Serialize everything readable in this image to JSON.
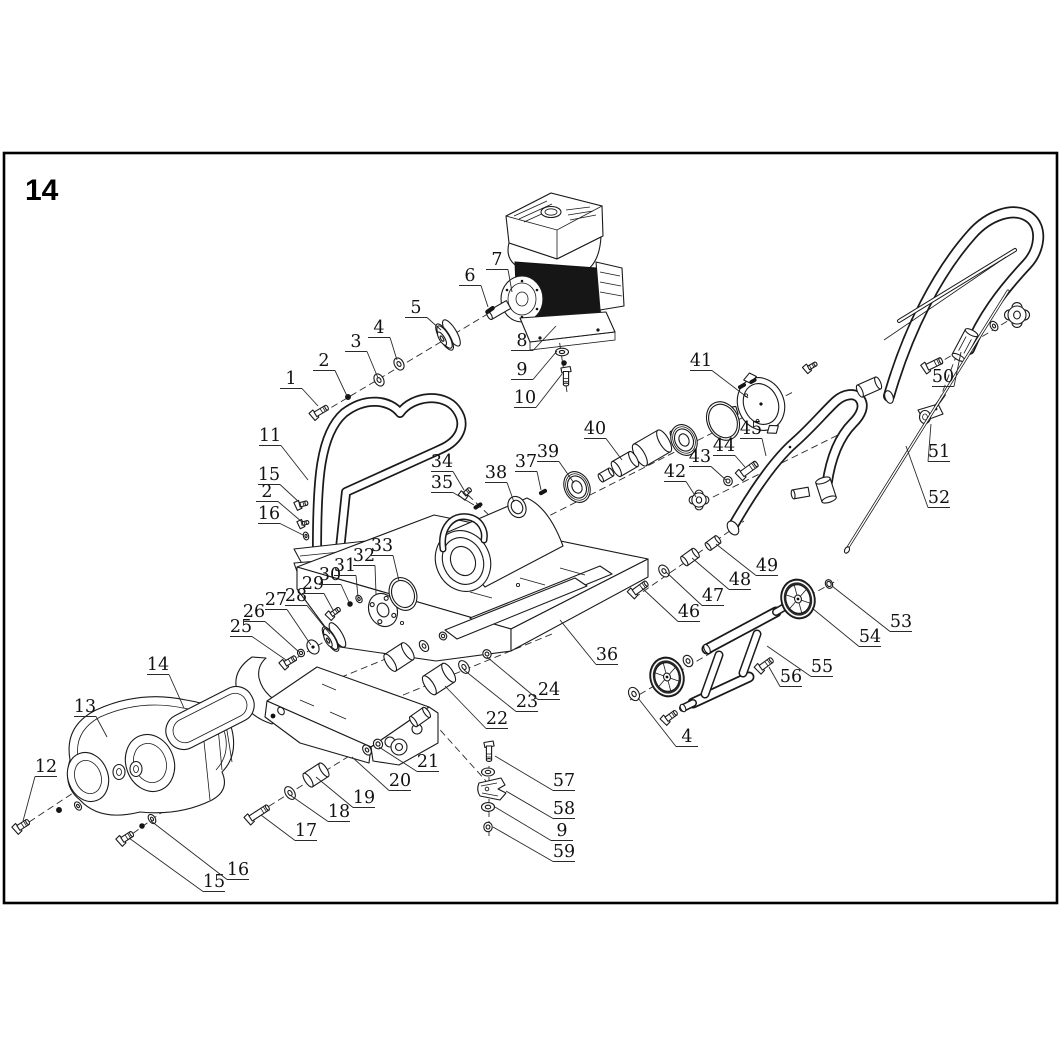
{
  "page": {
    "number": "14"
  },
  "figure": {
    "description": "Exploded parts diagram of a gasoline plate compactor",
    "frame_color": "#000000",
    "line_color": "#1a1a1a",
    "background": "#ffffff"
  },
  "callouts": [
    {
      "n": "1",
      "x": 291,
      "y": 384,
      "tx": 318,
      "ty": 406
    },
    {
      "n": "2",
      "x": 324,
      "y": 366,
      "tx": 347,
      "ty": 396
    },
    {
      "n": "3",
      "x": 356,
      "y": 347,
      "tx": 378,
      "ty": 378
    },
    {
      "n": "4",
      "x": 379,
      "y": 333,
      "tx": 397,
      "ty": 360
    },
    {
      "n": "5",
      "x": 416,
      "y": 313,
      "tx": 441,
      "ty": 330
    },
    {
      "n": "6",
      "x": 470,
      "y": 281,
      "tx": 488,
      "ty": 307
    },
    {
      "n": "7",
      "x": 497,
      "y": 265,
      "tx": 512,
      "ty": 292
    },
    {
      "n": "8",
      "x": 522,
      "y": 346,
      "tx": 556,
      "ty": 326
    },
    {
      "n": "9",
      "x": 522,
      "y": 375,
      "tx": 557,
      "ty": 351
    },
    {
      "n": "10",
      "x": 525,
      "y": 403,
      "tx": 562,
      "ty": 374
    },
    {
      "n": "11",
      "x": 270,
      "y": 441,
      "tx": 308,
      "ty": 480
    },
    {
      "n": "15",
      "x": 269,
      "y": 480,
      "tx": 300,
      "ty": 503
    },
    {
      "n": "2",
      "x": 267,
      "y": 497,
      "tx": 302,
      "ty": 522
    },
    {
      "n": "16",
      "x": 269,
      "y": 519,
      "tx": 303,
      "ty": 535
    },
    {
      "n": "12",
      "x": 46,
      "y": 772,
      "tx": 23,
      "ty": 821
    },
    {
      "n": "13",
      "x": 85,
      "y": 712,
      "tx": 107,
      "ty": 737
    },
    {
      "n": "14",
      "x": 158,
      "y": 670,
      "tx": 184,
      "ty": 708
    },
    {
      "n": "15",
      "x": 214,
      "y": 887,
      "tx": 129,
      "ty": 838
    },
    {
      "n": "16",
      "x": 238,
      "y": 875,
      "tx": 151,
      "ty": 821
    },
    {
      "n": "17",
      "x": 306,
      "y": 836,
      "tx": 261,
      "ty": 815
    },
    {
      "n": "18",
      "x": 339,
      "y": 817,
      "tx": 290,
      "ty": 795
    },
    {
      "n": "19",
      "x": 364,
      "y": 803,
      "tx": 316,
      "ty": 777
    },
    {
      "n": "20",
      "x": 400,
      "y": 786,
      "tx": 352,
      "ty": 757
    },
    {
      "n": "21",
      "x": 428,
      "y": 767,
      "tx": 379,
      "ty": 747
    },
    {
      "n": "22",
      "x": 497,
      "y": 724,
      "tx": 445,
      "ty": 686
    },
    {
      "n": "23",
      "x": 527,
      "y": 707,
      "tx": 464,
      "ty": 670
    },
    {
      "n": "24",
      "x": 549,
      "y": 695,
      "tx": 487,
      "ty": 657
    },
    {
      "n": "25",
      "x": 241,
      "y": 632,
      "tx": 286,
      "ty": 660
    },
    {
      "n": "26",
      "x": 254,
      "y": 617,
      "tx": 299,
      "ty": 652
    },
    {
      "n": "27",
      "x": 276,
      "y": 605,
      "tx": 311,
      "ty": 645
    },
    {
      "n": "28",
      "x": 296,
      "y": 601,
      "tx": 330,
      "ty": 634
    },
    {
      "n": "29",
      "x": 313,
      "y": 589,
      "tx": 333,
      "ty": 610
    },
    {
      "n": "30",
      "x": 330,
      "y": 580,
      "tx": 349,
      "ty": 602
    },
    {
      "n": "31",
      "x": 345,
      "y": 571,
      "tx": 358,
      "ty": 597
    },
    {
      "n": "32",
      "x": 364,
      "y": 561,
      "tx": 376,
      "ty": 594
    },
    {
      "n": "33",
      "x": 382,
      "y": 551,
      "tx": 399,
      "ty": 581
    },
    {
      "n": "34",
      "x": 442,
      "y": 467,
      "tx": 464,
      "ty": 490
    },
    {
      "n": "35",
      "x": 442,
      "y": 488,
      "tx": 474,
      "ty": 505
    },
    {
      "n": "36",
      "x": 607,
      "y": 660,
      "tx": 560,
      "ty": 620
    },
    {
      "n": "37",
      "x": 526,
      "y": 467,
      "tx": 541,
      "ty": 490
    },
    {
      "n": "38",
      "x": 496,
      "y": 478,
      "tx": 514,
      "ty": 502
    },
    {
      "n": "39",
      "x": 548,
      "y": 457,
      "tx": 574,
      "ty": 483
    },
    {
      "n": "40",
      "x": 595,
      "y": 434,
      "tx": 622,
      "ty": 460
    },
    {
      "n": "41",
      "x": 701,
      "y": 366,
      "tx": 748,
      "ty": 398
    },
    {
      "n": "42",
      "x": 675,
      "y": 477,
      "tx": 696,
      "ty": 497
    },
    {
      "n": "43",
      "x": 700,
      "y": 462,
      "tx": 726,
      "ty": 480
    },
    {
      "n": "44",
      "x": 724,
      "y": 451,
      "tx": 745,
      "ty": 467
    },
    {
      "n": "45",
      "x": 751,
      "y": 434,
      "tx": 766,
      "ty": 456
    },
    {
      "n": "46",
      "x": 689,
      "y": 617,
      "tx": 642,
      "ty": 588
    },
    {
      "n": "47",
      "x": 713,
      "y": 601,
      "tx": 666,
      "ty": 572
    },
    {
      "n": "48",
      "x": 740,
      "y": 585,
      "tx": 692,
      "ty": 558
    },
    {
      "n": "49",
      "x": 767,
      "y": 571,
      "tx": 716,
      "ty": 544
    },
    {
      "n": "50",
      "x": 943,
      "y": 382,
      "tx": 961,
      "ty": 352
    },
    {
      "n": "51",
      "x": 939,
      "y": 457,
      "tx": 931,
      "ty": 424
    },
    {
      "n": "52",
      "x": 939,
      "y": 503,
      "tx": 906,
      "ty": 446
    },
    {
      "n": "53",
      "x": 901,
      "y": 627,
      "tx": 832,
      "ty": 586
    },
    {
      "n": "54",
      "x": 870,
      "y": 642,
      "tx": 812,
      "ty": 608
    },
    {
      "n": "55",
      "x": 822,
      "y": 672,
      "tx": 767,
      "ty": 646
    },
    {
      "n": "56",
      "x": 791,
      "y": 682,
      "tx": 769,
      "ty": 667
    },
    {
      "n": "4",
      "x": 687,
      "y": 742,
      "tx": 638,
      "ty": 698
    },
    {
      "n": "57",
      "x": 564,
      "y": 786,
      "tx": 495,
      "ty": 756
    },
    {
      "n": "58",
      "x": 564,
      "y": 814,
      "tx": 506,
      "ty": 791
    },
    {
      "n": "9",
      "x": 562,
      "y": 836,
      "tx": 495,
      "ty": 807
    },
    {
      "n": "59",
      "x": 564,
      "y": 857,
      "tx": 493,
      "ty": 827
    }
  ],
  "axes": [
    {
      "x1": 322,
      "y1": 413,
      "x2": 506,
      "y2": 303
    },
    {
      "x1": 558,
      "y1": 332,
      "x2": 567,
      "y2": 392
    },
    {
      "x1": 462,
      "y1": 560,
      "x2": 795,
      "y2": 391
    },
    {
      "x1": 468,
      "y1": 495,
      "x2": 494,
      "y2": 520
    },
    {
      "x1": 703,
      "y1": 502,
      "x2": 846,
      "y2": 431
    },
    {
      "x1": 634,
      "y1": 598,
      "x2": 744,
      "y2": 521
    },
    {
      "x1": 630,
      "y1": 700,
      "x2": 716,
      "y2": 650
    },
    {
      "x1": 770,
      "y1": 617,
      "x2": 838,
      "y2": 580
    },
    {
      "x1": 926,
      "y1": 371,
      "x2": 1024,
      "y2": 311
    },
    {
      "x1": 957,
      "y1": 354,
      "x2": 936,
      "y2": 409
    },
    {
      "x1": 288,
      "y1": 663,
      "x2": 460,
      "y2": 562
    },
    {
      "x1": 337,
      "y1": 611,
      "x2": 390,
      "y2": 591
    },
    {
      "x1": 352,
      "y1": 716,
      "x2": 552,
      "y2": 634
    },
    {
      "x1": 310,
      "y1": 690,
      "x2": 500,
      "y2": 612
    },
    {
      "x1": 250,
      "y1": 818,
      "x2": 362,
      "y2": 748
    },
    {
      "x1": 20,
      "y1": 828,
      "x2": 108,
      "y2": 770
    },
    {
      "x1": 124,
      "y1": 840,
      "x2": 195,
      "y2": 788
    },
    {
      "x1": 489,
      "y1": 744,
      "x2": 489,
      "y2": 836
    },
    {
      "x1": 433,
      "y1": 722,
      "x2": 486,
      "y2": 781
    },
    {
      "x1": 176,
      "y1": 734,
      "x2": 240,
      "y2": 700
    }
  ],
  "hardware": [
    {
      "t": "bolt",
      "x": 321,
      "y": 411,
      "rot": -31,
      "a": 15,
      "b": 2.6
    },
    {
      "t": "dot",
      "x": 348,
      "y": 397,
      "rot": 0,
      "a": 2.6,
      "b": 0
    },
    {
      "t": "washer",
      "x": 379,
      "y": 380,
      "rot": -31,
      "a": 4.5,
      "b": 6.5
    },
    {
      "t": "washer",
      "x": 399,
      "y": 364,
      "rot": -31,
      "a": 4.5,
      "b": 6.5
    },
    {
      "t": "pulley",
      "x": 448,
      "y": 335,
      "rot": -31,
      "a": 15,
      "b": 0
    },
    {
      "t": "pin",
      "x": 490,
      "y": 310,
      "rot": -35,
      "a": 10,
      "b": 1.8
    },
    {
      "t": "washerF",
      "x": 562,
      "y": 352,
      "rot": 0,
      "a": 6.5,
      "b": 3.8
    },
    {
      "t": "dot",
      "x": 564,
      "y": 363,
      "rot": 0,
      "a": 2.4,
      "b": 0
    },
    {
      "t": "bolt",
      "x": 566,
      "y": 378,
      "rot": 90,
      "a": 15,
      "b": 2.6
    },
    {
      "t": "bolt",
      "x": 303,
      "y": 504,
      "rot": -15,
      "a": 9,
      "b": 2.2
    },
    {
      "t": "bolt",
      "x": 305,
      "y": 523,
      "rot": -15,
      "a": 7,
      "b": 1.8
    },
    {
      "t": "washer",
      "x": 306,
      "y": 536,
      "rot": -15,
      "a": 2.6,
      "b": 4
    },
    {
      "t": "bolt",
      "x": 467,
      "y": 492,
      "rot": -42,
      "a": 9,
      "b": 2.2
    },
    {
      "t": "pin",
      "x": 478,
      "y": 506,
      "rot": -32,
      "a": 9,
      "b": 1.7
    },
    {
      "t": "pin",
      "x": 543,
      "y": 492,
      "rot": -30,
      "a": 8,
      "b": 1.7
    },
    {
      "t": "ringp",
      "x": 517,
      "y": 507,
      "rot": -26,
      "a": 11,
      "b": 4
    },
    {
      "t": "bearing",
      "x": 577,
      "y": 487,
      "rot": -26,
      "a": 16,
      "b": 0
    },
    {
      "t": "cyl",
      "x": 679,
      "y": 433,
      "rot": -30,
      "a": 13,
      "b": 5.5
    },
    {
      "t": "cyl",
      "x": 652,
      "y": 448,
      "rot": -30,
      "a": 28,
      "b": 12.5
    },
    {
      "t": "cyl",
      "x": 625,
      "y": 464,
      "rot": -30,
      "a": 20,
      "b": 8.5
    },
    {
      "t": "cyl",
      "x": 606,
      "y": 475,
      "rot": -30,
      "a": 12,
      "b": 4.5
    },
    {
      "t": "bearing",
      "x": 684,
      "y": 440,
      "rot": -26,
      "a": 16,
      "b": 0
    },
    {
      "t": "ringp",
      "x": 723,
      "y": 421,
      "rot": -26,
      "a": 20,
      "b": 2.6
    },
    {
      "t": "pin",
      "x": 742,
      "y": 386,
      "rot": -30,
      "a": 8,
      "b": 1.6
    },
    {
      "t": "pin",
      "x": 753,
      "y": 381,
      "rot": -30,
      "a": 7,
      "b": 1.5
    },
    {
      "t": "bolt",
      "x": 812,
      "y": 366,
      "rot": -30,
      "a": 10,
      "b": 2
    },
    {
      "t": "star",
      "x": 699,
      "y": 500,
      "rot": 0,
      "a": 9.5,
      "b": 0
    },
    {
      "t": "nut",
      "x": 728,
      "y": 481,
      "rot": -26,
      "a": 4.2,
      "b": 0
    },
    {
      "t": "bolt",
      "x": 749,
      "y": 469,
      "rot": -36,
      "a": 19,
      "b": 3.2
    },
    {
      "t": "bolt",
      "x": 640,
      "y": 588,
      "rot": -36,
      "a": 17,
      "b": 3
    },
    {
      "t": "washer",
      "x": 664,
      "y": 571,
      "rot": -36,
      "a": 4.5,
      "b": 6.5
    },
    {
      "t": "cyl",
      "x": 690,
      "y": 557,
      "rot": -36,
      "a": 14,
      "b": 5.5
    },
    {
      "t": "cyl",
      "x": 713,
      "y": 543,
      "rot": -36,
      "a": 12,
      "b": 4.5
    },
    {
      "t": "washer",
      "x": 634,
      "y": 694,
      "rot": -28,
      "a": 5,
      "b": 7
    },
    {
      "t": "wheel",
      "x": 667,
      "y": 677,
      "rot": -15,
      "a": 20,
      "b": 0
    },
    {
      "t": "washer",
      "x": 688,
      "y": 661,
      "rot": -28,
      "a": 4.5,
      "b": 6
    },
    {
      "t": "wheel",
      "x": 798,
      "y": 599,
      "rot": -15,
      "a": 20,
      "b": 0
    },
    {
      "t": "ringp",
      "x": 829,
      "y": 584,
      "rot": -26,
      "a": 4.5,
      "b": 1.8
    },
    {
      "t": "bolt",
      "x": 766,
      "y": 664,
      "rot": -36,
      "a": 15,
      "b": 2.8
    },
    {
      "t": "bolt",
      "x": 671,
      "y": 716,
      "rot": -36,
      "a": 13,
      "b": 2.6
    },
    {
      "t": "bolt",
      "x": 259,
      "y": 813,
      "rot": -33,
      "a": 22,
      "b": 3
    },
    {
      "t": "washer",
      "x": 290,
      "y": 793,
      "rot": -33,
      "a": 4.5,
      "b": 7
    },
    {
      "t": "cyl",
      "x": 316,
      "y": 775,
      "rot": -33,
      "a": 19,
      "b": 8
    },
    {
      "t": "washer",
      "x": 367,
      "y": 750,
      "rot": -33,
      "a": 3.8,
      "b": 5.5
    },
    {
      "t": "nut",
      "x": 378,
      "y": 744,
      "rot": -33,
      "a": 4.4,
      "b": 0
    },
    {
      "t": "cyl",
      "x": 399,
      "y": 657,
      "rot": -33,
      "a": 21,
      "b": 10
    },
    {
      "t": "washer",
      "x": 424,
      "y": 646,
      "rot": -33,
      "a": 4,
      "b": 6
    },
    {
      "t": "nut",
      "x": 443,
      "y": 636,
      "rot": -33,
      "a": 3.6,
      "b": 0
    },
    {
      "t": "cyl",
      "x": 439,
      "y": 679,
      "rot": -33,
      "a": 23,
      "b": 11
    },
    {
      "t": "washer",
      "x": 464,
      "y": 667,
      "rot": -33,
      "a": 4.5,
      "b": 7
    },
    {
      "t": "nut",
      "x": 487,
      "y": 654,
      "rot": -33,
      "a": 4,
      "b": 0
    },
    {
      "t": "bolt",
      "x": 290,
      "y": 661,
      "rot": -31,
      "a": 13,
      "b": 2.6
    },
    {
      "t": "nut",
      "x": 301,
      "y": 653,
      "rot": -31,
      "a": 3.4,
      "b": 0
    },
    {
      "t": "washerD",
      "x": 313,
      "y": 647,
      "rot": -31,
      "a": 5.5,
      "b": 7.5
    },
    {
      "t": "pulley",
      "x": 334,
      "y": 637,
      "rot": -31,
      "a": 14,
      "b": 0
    },
    {
      "t": "bolt",
      "x": 335,
      "y": 612,
      "rot": -36,
      "a": 11,
      "b": 2.2
    },
    {
      "t": "dot",
      "x": 350,
      "y": 604,
      "rot": 0,
      "a": 2.4,
      "b": 0
    },
    {
      "t": "washer",
      "x": 359,
      "y": 599,
      "rot": -31,
      "a": 2.8,
      "b": 4
    },
    {
      "t": "flange",
      "x": 383,
      "y": 610,
      "rot": -24,
      "a": 17,
      "b": 0
    },
    {
      "t": "ringp",
      "x": 403,
      "y": 594,
      "rot": -24,
      "a": 17,
      "b": 3
    },
    {
      "t": "bolt",
      "x": 23,
      "y": 825,
      "rot": -33,
      "a": 13,
      "b": 2.8
    },
    {
      "t": "dot",
      "x": 59,
      "y": 810,
      "rot": 0,
      "a": 2.6,
      "b": 0
    },
    {
      "t": "washer",
      "x": 78,
      "y": 806,
      "rot": -33,
      "a": 3,
      "b": 4.5
    },
    {
      "t": "bolt",
      "x": 127,
      "y": 837,
      "rot": -33,
      "a": 13,
      "b": 2.8
    },
    {
      "t": "dot",
      "x": 142,
      "y": 826,
      "rot": 0,
      "a": 2.4,
      "b": 0
    },
    {
      "t": "washer",
      "x": 152,
      "y": 819,
      "rot": -33,
      "a": 3.2,
      "b": 5
    },
    {
      "t": "bolt",
      "x": 489,
      "y": 753,
      "rot": 90,
      "a": 16,
      "b": 2.6
    },
    {
      "t": "washerF",
      "x": 488,
      "y": 772,
      "rot": 0,
      "a": 6.5,
      "b": 4
    },
    {
      "t": "washerF",
      "x": 488,
      "y": 807,
      "rot": 0,
      "a": 6.5,
      "b": 4.4
    },
    {
      "t": "nut",
      "x": 488,
      "y": 827,
      "rot": 0,
      "a": 4.2,
      "b": 0
    },
    {
      "t": "star",
      "x": 1017,
      "y": 315,
      "rot": 0,
      "a": 12,
      "b": 0
    },
    {
      "t": "washer",
      "x": 994,
      "y": 326,
      "rot": -30,
      "a": 3.5,
      "b": 5
    },
    {
      "t": "bolt",
      "x": 934,
      "y": 364,
      "rot": -26,
      "a": 17,
      "b": 3.2
    },
    {
      "t": "cyl",
      "x": 869,
      "y": 387,
      "rot": -24,
      "a": 20,
      "b": 6.5
    }
  ]
}
